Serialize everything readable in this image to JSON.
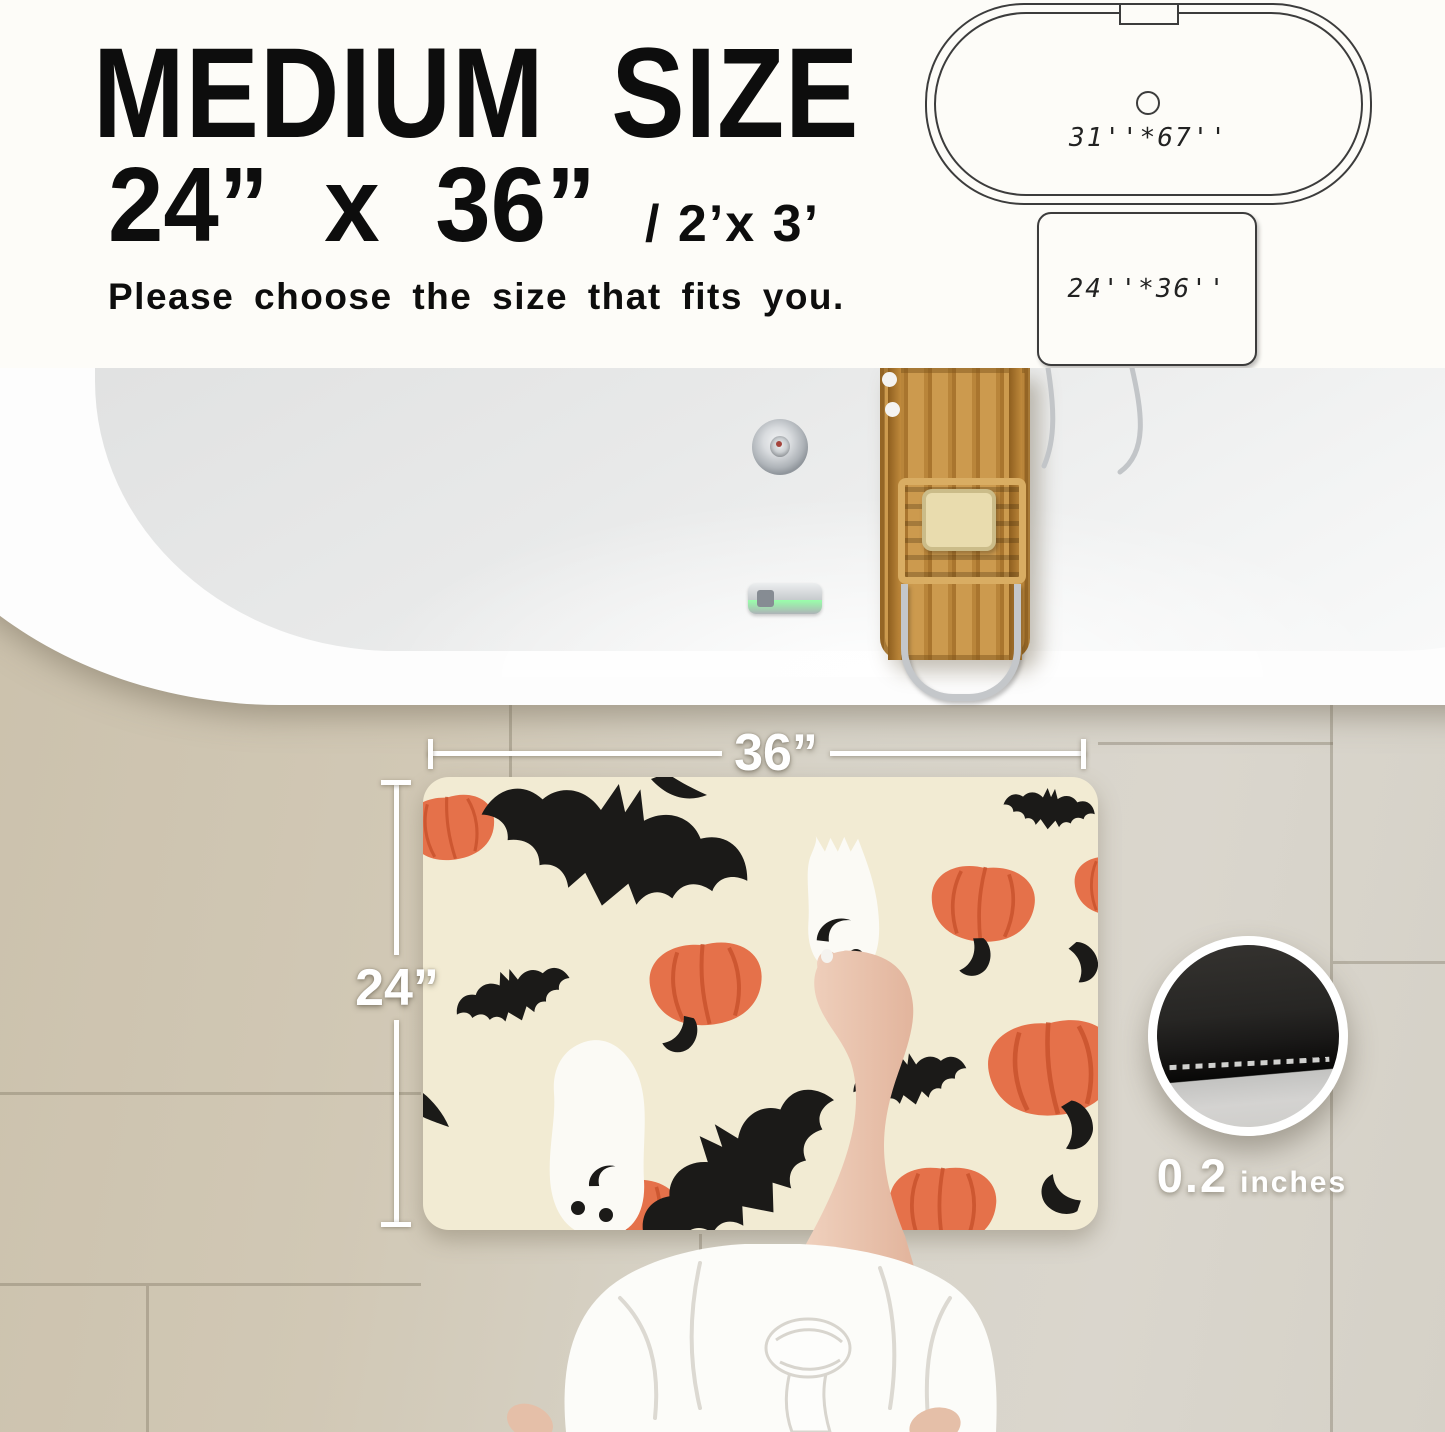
{
  "header": {
    "title": "MEDIUM SIZE",
    "size_primary": "24” x 36”",
    "size_secondary": "/ 2’x 3’",
    "note": "Please choose the size that fits you."
  },
  "size_diagram": {
    "bathtub_label": "31''*67''",
    "mat_label": "24''*36''"
  },
  "photo": {
    "width_label": "36”",
    "height_label": "24”",
    "thickness": {
      "value": "0.2",
      "unit": "inches"
    }
  },
  "colors": {
    "page_background": "#FDFCF8",
    "heading_text": "#0D0D0D",
    "mat_cream": "#F2EBD3",
    "pumpkin_orange": "#E5714A",
    "bat_black": "#1B1A18",
    "ghost_white": "#FBFAF5",
    "tile_beige": "#D2C9B6",
    "bamboo_wood": "#C9984B",
    "chrome": "#C2C5C8",
    "dimension_white": "#FFFFFF"
  }
}
